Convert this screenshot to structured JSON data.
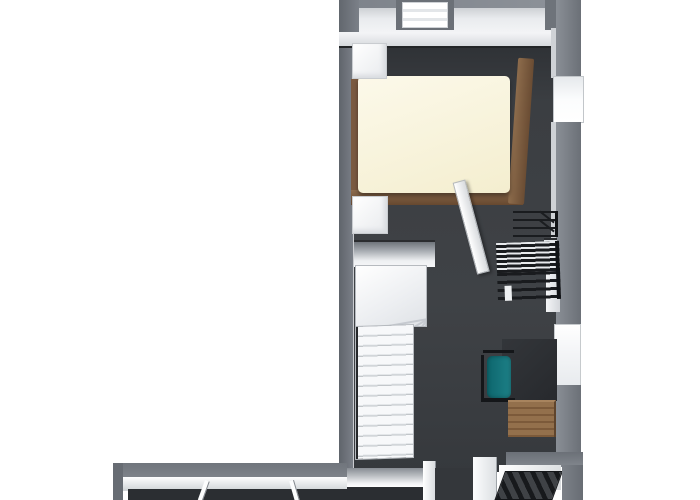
{
  "scene": {
    "title": "3D Floor Plan - Upper Floor",
    "description": "Top-down 3D rendering of an upper floor: a narrow bedroom wing at the top with a double bed with wooden frame and cream duvet, two white nightstands, a black metal clothes rack, an open interior door, a white winder staircase leading down, a desk nook with a teal office chair and a wooden side table, two windows in the right wall and a chimney recess in the top wall; a hallway wing at the bottom with interior doors, a doorway opening and a dark staircase going down.",
    "view": "top-down orthographic",
    "background": "white"
  },
  "rooms": [
    {
      "name": "bedroom",
      "items": [
        "double bed with wooden frame and cream duvet",
        "nightstand top-left",
        "nightstand bottom-left",
        "black metal clothes rack",
        "window in right wall (upper)",
        "chimney recess in top wall"
      ]
    },
    {
      "name": "stair-landing-study",
      "items": [
        "white winder staircase",
        "open interior door",
        "black metal shelf unit",
        "dark desk top",
        "teal office chair with black frame",
        "wooden side table",
        "window in right wall (lower)"
      ]
    },
    {
      "name": "hallway",
      "items": [
        "interior door (left)",
        "interior door (middle)",
        "door jamb and doorway opening",
        "dark staircase going down"
      ]
    }
  ],
  "colors": {
    "background": "#ffffff",
    "floor": "#3b3e42",
    "floor-dark": "#2b2e32",
    "wall-outer": "#70757c",
    "wall-inner": "#f2f3f5",
    "bed-duvet": "#f4eecf",
    "bed-wood": "#7a5a41",
    "table-wood": "#8a6845",
    "chair-teal": "#1d8087",
    "desk-top": "#27292d",
    "metal-black": "#1a1c1f"
  }
}
